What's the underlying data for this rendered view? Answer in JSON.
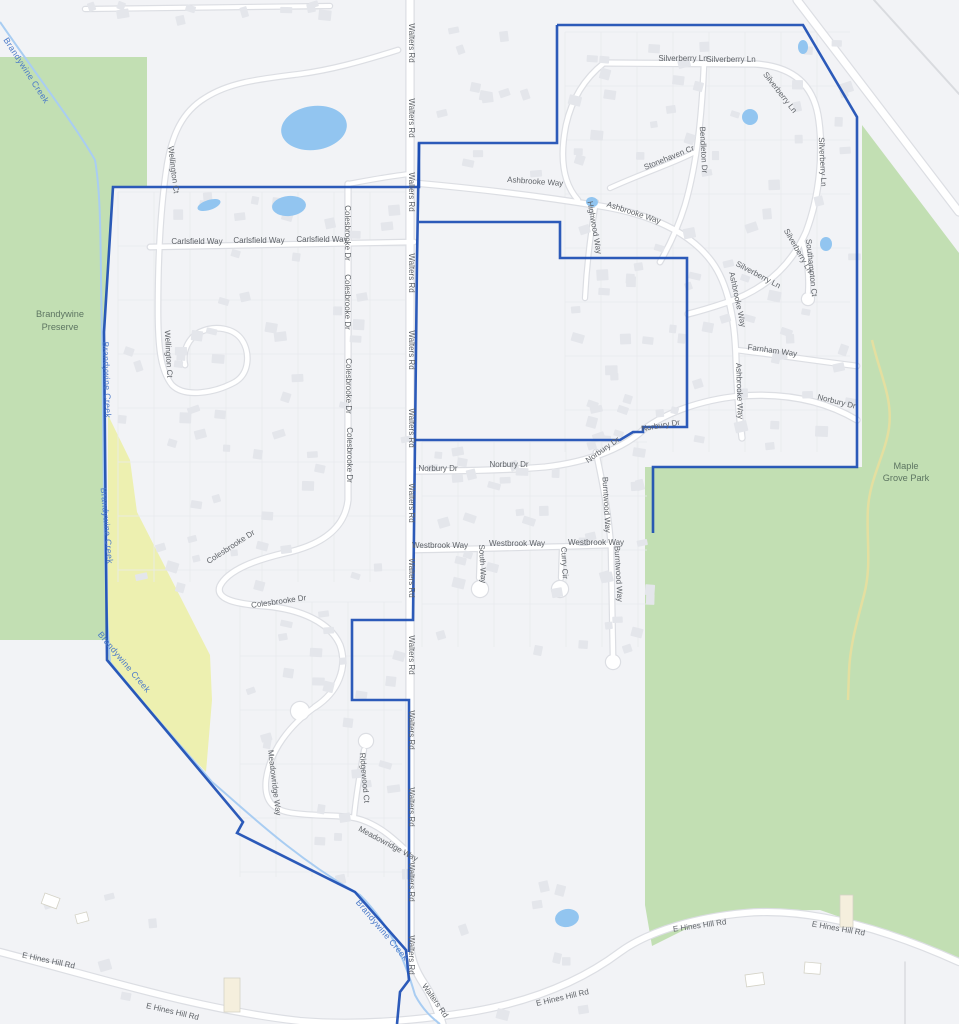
{
  "map": {
    "width": 959,
    "height": 1024,
    "colors": {
      "bg": "#f2f3f6",
      "green": "#c2dfb3",
      "yellow": "#edf0b0",
      "pond": "#92c5f0",
      "creek": "#a9cdf2",
      "boundary": "#1b4db3",
      "road_fill": "#ffffff",
      "road_casing": "#dcdee3",
      "minor_line": "#d9dbdf",
      "street_label": "#5f6368",
      "water_label": "#4a79c8",
      "park_label": "#5d7562",
      "house": "#e4e6eb",
      "house_beige": "#f5efdd",
      "parcel": "#e8eaee",
      "trail": "#e4dfa0"
    },
    "areas": [
      {
        "name": "brandywine-preserve-green",
        "points": "0,57 147,57 147,186 113,186 104,332 107,640 0,640"
      },
      {
        "name": "maple-grove-park-green",
        "points": "862,125 959,253 959,958 900,938 820,910 750,911 700,922 652,946 645,905 645,467 862,467"
      },
      {
        "name": "floodplain-yellow",
        "points": "108,415 130,460 137,512 210,655 212,700 206,772 150,713 108,660"
      }
    ],
    "area_labels": [
      {
        "name": "brandywine-preserve-label",
        "lines": [
          "Brandywine",
          "Preserve"
        ],
        "x": 60,
        "y": 317,
        "lh": 13
      },
      {
        "name": "maple-grove-park-label",
        "lines": [
          "Maple",
          "Grove Park"
        ],
        "x": 906,
        "y": 469,
        "lh": 12
      }
    ],
    "boundary": [
      "M557,25 L803,25 L857,117 L857,467 L653,467 L653,533",
      "M557,25 L557,143 L419,143 L419,187 L113,187 L104,332 L107,660 L243,822 L237,833 L355,892 L406,950 L409,980 L400,992 L397,1024",
      "M419,143 L417,260 L415,440 L413,620 L352,620 L352,700 L409,700 L409,952",
      "M414,440 L620,440 L633,432 L643,432 L643,427 L687,427 L687,258 L560,258 L560,222 L419,222"
    ],
    "creek": {
      "d": "M0,22 C40,80 75,125 95,160 C102,200 100,260 102,330 L104,500 C105,560 106,610 110,662 C140,700 180,745 212,782 C240,805 290,855 360,895 C390,925 405,960 415,995 C423,1010 432,1018 440,1024",
      "labels": [
        {
          "t": "Brandywine Creek",
          "x": 24,
          "y": 72,
          "r": 57
        },
        {
          "t": "Brandywine Creek",
          "x": 104,
          "y": 380,
          "r": 88
        },
        {
          "t": "Brandywine Creek",
          "x": 104,
          "y": 526,
          "r": 85
        },
        {
          "t": "Brandywine Creek",
          "x": 122,
          "y": 664,
          "r": 50
        },
        {
          "t": "Brandywine Creek",
          "x": 380,
          "y": 932,
          "r": 50
        }
      ]
    },
    "trail": "M872,340 C880,375 893,398 889,428 C885,455 870,478 868,508 C866,538 872,565 864,595 C857,622 850,645 849,672 L848,700",
    "ponds": [
      {
        "cx": 314,
        "cy": 128,
        "rx": 33,
        "ry": 22,
        "rot": -8
      },
      {
        "cx": 209,
        "cy": 205,
        "rx": 12,
        "ry": 5,
        "rot": -18
      },
      {
        "cx": 289,
        "cy": 206,
        "rx": 17,
        "ry": 10,
        "rot": -5
      },
      {
        "cx": 803,
        "cy": 47,
        "rx": 5,
        "ry": 7,
        "rot": 0
      },
      {
        "cx": 750,
        "cy": 117,
        "rx": 8,
        "ry": 8,
        "rot": 0
      },
      {
        "cx": 826,
        "cy": 244,
        "rx": 6,
        "ry": 7,
        "rot": 0
      },
      {
        "cx": 592,
        "cy": 202,
        "rx": 6,
        "ry": 5,
        "rot": 10
      },
      {
        "cx": 567,
        "cy": 918,
        "rx": 12,
        "ry": 9,
        "rot": -10
      }
    ],
    "roads": [
      {
        "name": "walters-rd",
        "d": "M410,0 L410,948 C411,960 416,972 424,984 C432,996 438,1010 442,1024",
        "w": 7
      },
      {
        "name": "e-hines-hill-rd",
        "d": "M0,952 C100,978 200,1010 300,1021 C360,1026 420,1020 470,1012 C530,1002 580,982 620,952 C650,930 700,917 745,913 C800,908 870,922 959,962",
        "w": 6
      },
      {
        "name": "highway",
        "d": "M797,0 L959,212",
        "w": 7
      },
      {
        "name": "highway-frontage",
        "d": "M874,0 L959,94",
        "w": 2,
        "line": true
      },
      {
        "name": "ashbrooke-way",
        "d": "M414,183 C470,188 540,196 600,206 C650,214 690,232 712,262 C728,284 735,320 736,360 C737,390 739,415 742,438",
        "w": 5
      },
      {
        "name": "norbury-dr",
        "d": "M414,471 C460,471 510,470 545,467 C590,462 625,447 643,430 C665,413 700,400 740,396 C780,393 820,398 857,420",
        "w": 5
      },
      {
        "name": "farnham-way",
        "d": "M736,350 C770,354 810,360 857,366",
        "w": 4.5
      },
      {
        "name": "silverberry-ln",
        "d": "M604,63 L755,64 C790,66 812,82 818,115 C824,150 820,195 806,232 C790,268 762,291 725,303 C710,308 696,312 688,314",
        "w": 5
      },
      {
        "name": "bendleton-dr",
        "d": "M704,64 C702,110 698,160 685,205 C678,228 668,248 660,262",
        "w": 4.5
      },
      {
        "name": "stonehaven-cr",
        "d": "M695,152 C675,163 645,172 610,188",
        "w": 4
      },
      {
        "name": "highwood-way",
        "d": "M596,202 C591,230 587,260 585,298",
        "w": 4
      },
      {
        "name": "southampton-ct",
        "d": "M803,243 C807,258 809,275 808,292",
        "w": 4
      },
      {
        "name": "silverberry-west-leg",
        "d": "M604,63 C585,78 572,98 566,125 C560,155 562,182 578,200",
        "w": 4.5
      },
      {
        "name": "wellington-ct",
        "d": "M398,50 C360,62 330,70 300,74 C260,79 230,82 205,98 C182,112 172,135 167,165 C160,210 158,260 158,310 C158,345 160,370 172,385 C185,398 215,393 235,382 C250,373 250,352 242,340 C234,328 215,325 200,332 C188,338 182,352 185,365",
        "w": 4.5
      },
      {
        "name": "carlsfield-way",
        "d": "M150,247 L414,242",
        "w": 4.5
      },
      {
        "name": "colesbrooke-dr",
        "d": "M348,184 L348,500 C345,528 322,545 285,553 C255,560 228,570 220,586 C215,599 235,604 265,606 C300,609 330,622 340,645 C348,668 338,692 315,707",
        "w": 5
      },
      {
        "name": "colesbrooke-connector",
        "d": "M348,184 C370,180 390,176 410,174",
        "w": 4
      },
      {
        "name": "meadowridge-way",
        "d": "M315,707 C290,725 270,750 266,780 C264,800 272,810 292,813 C320,817 345,814 362,820 C382,827 395,840 408,852",
        "w": 4.5
      },
      {
        "name": "ridgewood-ct",
        "d": "M354,817 C356,795 360,772 364,750",
        "w": 4
      },
      {
        "name": "burntwood-way",
        "d": "M596,452 C603,485 609,515 611,548 L613,655",
        "w": 4.5
      },
      {
        "name": "westbrook-way",
        "d": "M414,550 C480,549 545,547 612,545",
        "w": 4.5
      },
      {
        "name": "south-way",
        "d": "M480,549 L479,578",
        "w": 4
      },
      {
        "name": "curry-cir",
        "d": "M562,547 L561,578",
        "w": 4
      },
      {
        "name": "top-road",
        "d": "M85,9 L330,6",
        "w": 4
      },
      {
        "name": "driveway",
        "d": "M905,962 L905,1024",
        "w": 1.5,
        "line": true
      }
    ],
    "culdesacs": [
      {
        "cx": 808,
        "cy": 299,
        "r": 6
      },
      {
        "cx": 480,
        "cy": 589,
        "r": 8
      },
      {
        "cx": 560,
        "cy": 589,
        "r": 8
      },
      {
        "cx": 300,
        "cy": 711,
        "r": 9
      },
      {
        "cx": 366,
        "cy": 741,
        "r": 7
      },
      {
        "cx": 613,
        "cy": 662,
        "r": 7
      }
    ],
    "street_labels": [
      {
        "t": "Walters Rd",
        "x": 409,
        "y": 43,
        "r": 90
      },
      {
        "t": "Walters Rd",
        "x": 409,
        "y": 118,
        "r": 90
      },
      {
        "t": "Walters Rd",
        "x": 409,
        "y": 192,
        "r": 90
      },
      {
        "t": "Walters Rd",
        "x": 409,
        "y": 273,
        "r": 90
      },
      {
        "t": "Walters Rd",
        "x": 409,
        "y": 350,
        "r": 90
      },
      {
        "t": "Walters Rd",
        "x": 409,
        "y": 428,
        "r": 90
      },
      {
        "t": "Walters Rd",
        "x": 409,
        "y": 503,
        "r": 90
      },
      {
        "t": "Walters Rd",
        "x": 409,
        "y": 578,
        "r": 90
      },
      {
        "t": "Walters Rd",
        "x": 409,
        "y": 655,
        "r": 90
      },
      {
        "t": "Walters Rd",
        "x": 409,
        "y": 730,
        "r": 90
      },
      {
        "t": "Walters Rd",
        "x": 409,
        "y": 807,
        "r": 90
      },
      {
        "t": "Walters Rd",
        "x": 409,
        "y": 882,
        "r": 90
      },
      {
        "t": "Walters Rd",
        "x": 409,
        "y": 955,
        "r": 90
      },
      {
        "t": "Walters Rd",
        "x": 433,
        "y": 1002,
        "r": 55
      },
      {
        "t": "Ashbrooke Way",
        "x": 535,
        "y": 184,
        "r": 4
      },
      {
        "t": "Ashbrooke Way",
        "x": 633,
        "y": 215,
        "r": 18
      },
      {
        "t": "Ashbrooke Way",
        "x": 735,
        "y": 300,
        "r": 78
      },
      {
        "t": "Ashbrooke Way",
        "x": 737,
        "y": 391,
        "r": 88
      },
      {
        "t": "Silverberry Ln",
        "x": 683,
        "y": 61,
        "r": 0
      },
      {
        "t": "Silverberry Ln",
        "x": 731,
        "y": 62,
        "r": 0
      },
      {
        "t": "Silverberry Ln",
        "x": 778,
        "y": 94,
        "r": 52
      },
      {
        "t": "Silverberry Ln",
        "x": 820,
        "y": 162,
        "r": 87
      },
      {
        "t": "Silverberry Ln",
        "x": 796,
        "y": 252,
        "r": 60
      },
      {
        "t": "Silverberry Ln",
        "x": 757,
        "y": 277,
        "r": 28
      },
      {
        "t": "Bendleton Dr",
        "x": 701,
        "y": 150,
        "r": 87
      },
      {
        "t": "Stonehaven Cr",
        "x": 670,
        "y": 160,
        "r": -22
      },
      {
        "t": "Highwood Way",
        "x": 592,
        "y": 228,
        "r": 80
      },
      {
        "t": "Southampton Ct",
        "x": 809,
        "y": 268,
        "r": 84
      },
      {
        "t": "Farnham Way",
        "x": 772,
        "y": 353,
        "r": 8
      },
      {
        "t": "Norbury Dr",
        "x": 438,
        "y": 471,
        "r": 0
      },
      {
        "t": "Norbury Dr",
        "x": 509,
        "y": 467,
        "r": 0
      },
      {
        "t": "Norbury Dr",
        "x": 604,
        "y": 452,
        "r": -35
      },
      {
        "t": "Norbury Dr",
        "x": 661,
        "y": 428,
        "r": -10
      },
      {
        "t": "Norbury Dr",
        "x": 836,
        "y": 404,
        "r": 14
      },
      {
        "t": "Burntwood Way",
        "x": 604,
        "y": 505,
        "r": 87
      },
      {
        "t": "Burntwood Way",
        "x": 616,
        "y": 574,
        "r": 87
      },
      {
        "t": "Westbrook Way",
        "x": 440,
        "y": 548,
        "r": 0
      },
      {
        "t": "Westbrook Way",
        "x": 517,
        "y": 546,
        "r": 0
      },
      {
        "t": "Westbrook Way",
        "x": 596,
        "y": 545,
        "r": 0
      },
      {
        "t": "South Way",
        "x": 480,
        "y": 564,
        "r": 87
      },
      {
        "t": "Curry Cir",
        "x": 562,
        "y": 563,
        "r": 87
      },
      {
        "t": "Wellington Ct",
        "x": 171,
        "y": 170,
        "r": 83
      },
      {
        "t": "Wellington Ct",
        "x": 166,
        "y": 354,
        "r": 87
      },
      {
        "t": "Carlsfield Way",
        "x": 197,
        "y": 244,
        "r": 0
      },
      {
        "t": "Carlsfield Way",
        "x": 259,
        "y": 243,
        "r": 0
      },
      {
        "t": "Carlsfield Way",
        "x": 322,
        "y": 242,
        "r": 0
      },
      {
        "t": "Colesbrooke Dr",
        "x": 345,
        "y": 233,
        "r": 90
      },
      {
        "t": "Colesbrooke Dr",
        "x": 345,
        "y": 302,
        "r": 90
      },
      {
        "t": "Colesbrooke Dr",
        "x": 346,
        "y": 386,
        "r": 90
      },
      {
        "t": "Colesbrooke Dr",
        "x": 347,
        "y": 455,
        "r": 90
      },
      {
        "t": "Colesbrooke Dr",
        "x": 232,
        "y": 549,
        "r": -33
      },
      {
        "t": "Colesbrooke Dr",
        "x": 279,
        "y": 604,
        "r": -8
      },
      {
        "t": "Meadowridge Way",
        "x": 272,
        "y": 783,
        "r": 83
      },
      {
        "t": "Meadowridge Way",
        "x": 387,
        "y": 846,
        "r": 28
      },
      {
        "t": "Ridgewood Ct",
        "x": 362,
        "y": 778,
        "r": 85
      },
      {
        "t": "E Hines Hill Rd",
        "x": 48,
        "y": 963,
        "r": 12
      },
      {
        "t": "E Hines Hill Rd",
        "x": 172,
        "y": 1014,
        "r": 13
      },
      {
        "t": "E Hines Hill Rd",
        "x": 563,
        "y": 1000,
        "r": -13
      },
      {
        "t": "E Hines Hill Rd",
        "x": 700,
        "y": 928,
        "r": -8
      },
      {
        "t": "E Hines Hill Rd",
        "x": 838,
        "y": 931,
        "r": 10
      }
    ],
    "special_buildings": [
      {
        "x": 224,
        "y": 978,
        "w": 16,
        "h": 34,
        "r": 0,
        "beige": true
      },
      {
        "x": 840,
        "y": 895,
        "w": 13,
        "h": 32,
        "r": 0,
        "beige": true
      },
      {
        "x": 745,
        "y": 975,
        "w": 18,
        "h": 12,
        "r": -8,
        "beige": false
      },
      {
        "x": 805,
        "y": 962,
        "w": 16,
        "h": 11,
        "r": 5,
        "beige": false
      },
      {
        "x": 45,
        "y": 893,
        "w": 16,
        "h": 11,
        "r": 20,
        "beige": false
      },
      {
        "x": 75,
        "y": 915,
        "w": 12,
        "h": 9,
        "r": -15,
        "beige": false
      }
    ]
  }
}
